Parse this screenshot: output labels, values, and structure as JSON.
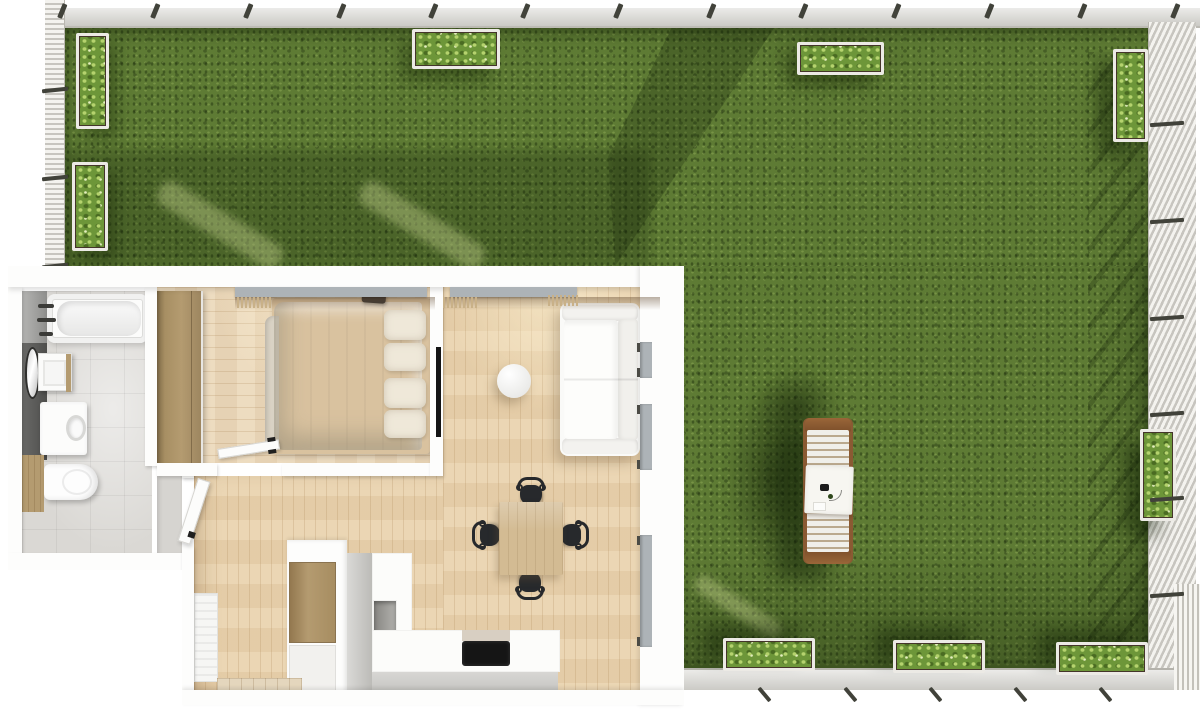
{
  "scene": {
    "description": "Top-down 3D architectural render of a one-bedroom apartment floor plan with a large fenced lawn garden",
    "visible_text": []
  },
  "palette": {
    "grass_base": "#5e7b34",
    "fence_band": "#d8d7d2",
    "fence_post": "#41423a",
    "fence_slat": "#f4f3ef",
    "fence_slat_shade": "#c7c5bf",
    "planter_frame": "#eceae5",
    "planter_soil": "#44352a",
    "foliage": "#6d9639",
    "foliage_light": "#b5d36e",
    "foliage_dark": "#4a6b22",
    "bath_floor": "#dad8d4",
    "wood_floor": "#ecd9bb",
    "wood_floor_warm": "#ead3ae",
    "wardrobe_wood": "#b49b70",
    "bed_frame": "#d9c29f",
    "glass": "#adb3b7",
    "table_wood": "#d3bb93",
    "chair_black": "#27292c",
    "tv_black": "#141414",
    "counter_gray": "#c6c5c1",
    "cooktop_black": "#151515",
    "lounger_wood": "#8a5a33",
    "lounger_slat": "#f0efea",
    "tile_mat": "#e4d6bd",
    "fringe": "#c9b188"
  },
  "garden": {
    "planters": [
      {
        "id": "planter-left-1",
        "x": 76,
        "y": 33,
        "w": 33,
        "h": 96,
        "group": "left"
      },
      {
        "id": "planter-left-2",
        "x": 72,
        "y": 162,
        "w": 36,
        "h": 89,
        "group": "left"
      },
      {
        "id": "planter-top-1",
        "x": 412,
        "y": 29,
        "w": 88,
        "h": 40,
        "group": "top"
      },
      {
        "id": "planter-top-2",
        "x": 797,
        "y": 42,
        "w": 87,
        "h": 33,
        "group": "top"
      },
      {
        "id": "planter-right-1",
        "x": 1113,
        "y": 49,
        "w": 35,
        "h": 93,
        "group": "right"
      },
      {
        "id": "planter-right-2",
        "x": 1140,
        "y": 429,
        "w": 36,
        "h": 92,
        "group": "right"
      },
      {
        "id": "planter-bottom-1",
        "x": 723,
        "y": 638,
        "w": 92,
        "h": 33,
        "group": "bottom"
      },
      {
        "id": "planter-bottom-2",
        "x": 893,
        "y": 640,
        "w": 92,
        "h": 33,
        "group": "bottom"
      },
      {
        "id": "planter-bottom-3",
        "x": 1056,
        "y": 642,
        "w": 92,
        "h": 33,
        "group": "bottom"
      }
    ],
    "fence_posts": {
      "top_x": [
        57,
        150,
        243,
        336,
        428,
        520,
        613,
        706,
        798,
        891,
        984,
        1077,
        1170
      ],
      "left_y": [
        88,
        176,
        264
      ],
      "right_y": [
        122,
        219,
        316,
        412,
        497,
        593
      ],
      "bottom_x": [
        757,
        843,
        928,
        1013,
        1098
      ]
    },
    "light_streaks": [
      {
        "x": 150,
        "y": 212,
        "len": 140,
        "w": 26,
        "deg": 31
      },
      {
        "x": 352,
        "y": 212,
        "len": 140,
        "w": 26,
        "deg": 31
      },
      {
        "x": 688,
        "y": 598,
        "len": 100,
        "w": 18,
        "deg": 33
      }
    ],
    "lounger": {
      "accessories": [
        "phone",
        "drink",
        "card",
        "headphone-wire",
        "towel"
      ]
    }
  },
  "apartment": {
    "rooms": [
      "bathroom",
      "bedroom",
      "living-room",
      "kitchen",
      "hallway"
    ],
    "bathroom_fixtures": [
      "bathtub",
      "towel-rails",
      "mirror",
      "washbasin",
      "washing-machine",
      "toilet",
      "wood-panel"
    ],
    "bedroom_furniture": [
      "wardrobe",
      "double-bed",
      "pillows",
      "wall-speaker",
      "door"
    ],
    "living_furniture": [
      "sofa",
      "coffee-table",
      "wall-tv",
      "dining-table",
      "dining-chairs"
    ],
    "kitchen_units": [
      "tall-cabinet",
      "l-shaped-counter",
      "wall-niche",
      "cooktop"
    ],
    "hallway_items": [
      "front-door",
      "radiator",
      "doormat"
    ],
    "windows_north": [
      {
        "x": 227,
        "w": 192
      },
      {
        "x": 442,
        "w": 127
      }
    ],
    "windows_east": [
      {
        "y": 76,
        "h": 36
      },
      {
        "y": 138,
        "h": 66
      },
      {
        "y": 269,
        "h": 112
      }
    ],
    "dining_chairs": [
      {
        "x": 508,
        "y": 211,
        "deg": 0
      },
      {
        "x": 551,
        "y": 254,
        "deg": 90
      },
      {
        "x": 507,
        "y": 304,
        "deg": 180
      },
      {
        "x": 464,
        "y": 254,
        "deg": 270
      }
    ],
    "bed_pillows": [
      {
        "x": 376,
        "y": 44,
        "w": 42,
        "h": 30
      },
      {
        "x": 376,
        "y": 77,
        "w": 42,
        "h": 28
      },
      {
        "x": 376,
        "y": 112,
        "w": 42,
        "h": 30
      },
      {
        "x": 376,
        "y": 144,
        "w": 42,
        "h": 28
      }
    ]
  }
}
